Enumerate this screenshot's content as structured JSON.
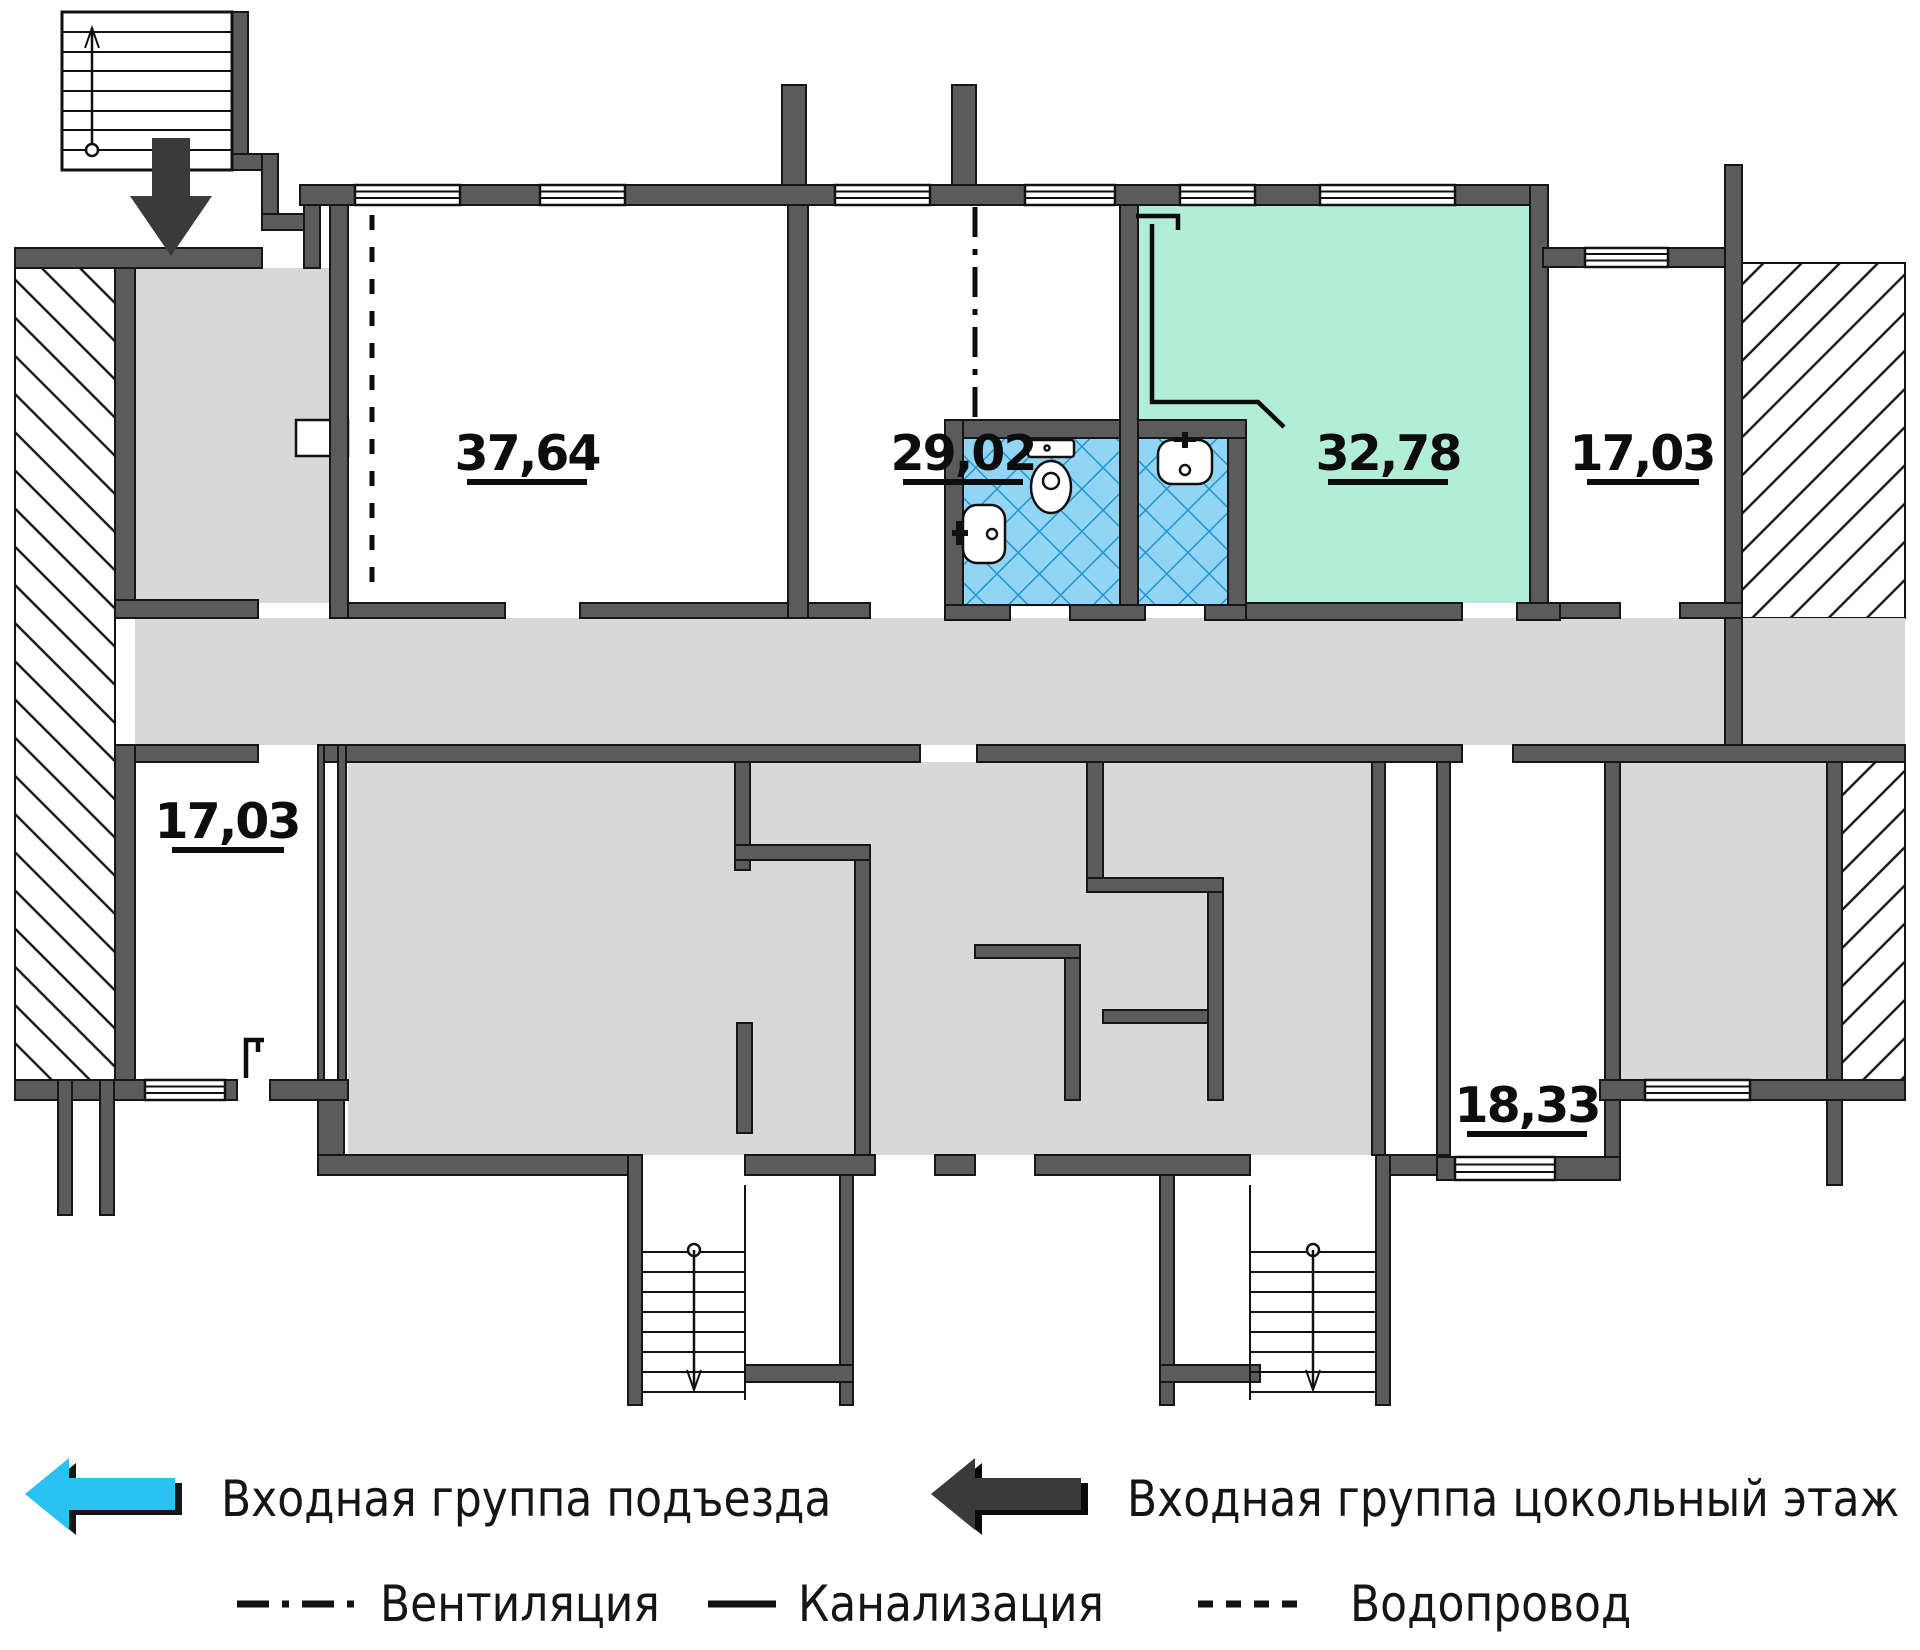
{
  "plan": {
    "rooms": [
      {
        "name": "room-37-64",
        "area": "37,64"
      },
      {
        "name": "room-29-02",
        "area": "29,02"
      },
      {
        "name": "room-32-78",
        "area": "32,78",
        "highlighted": true
      },
      {
        "name": "room-17-03-top-right",
        "area": "17,03"
      },
      {
        "name": "room-17-03-bottom-left",
        "area": "17,03"
      },
      {
        "name": "room-18-33",
        "area": "18,33"
      }
    ],
    "colors": {
      "wall": "#5b5b5b",
      "corridor": "#d8d8d8",
      "highlight": "#b2edd7",
      "bathroom_fill": "#92d4f4",
      "bathroom_line": "#1f96d4",
      "arrow_blue": "#29c3f2",
      "arrow_dark": "#3a3a3a"
    }
  },
  "legend": {
    "entrance_main": "Входная группа подъезда",
    "entrance_basement": "Входная группа цокольный этаж",
    "ventilation": "Вентиляция",
    "sewerage": "Канализация",
    "water": "Водопровод"
  }
}
